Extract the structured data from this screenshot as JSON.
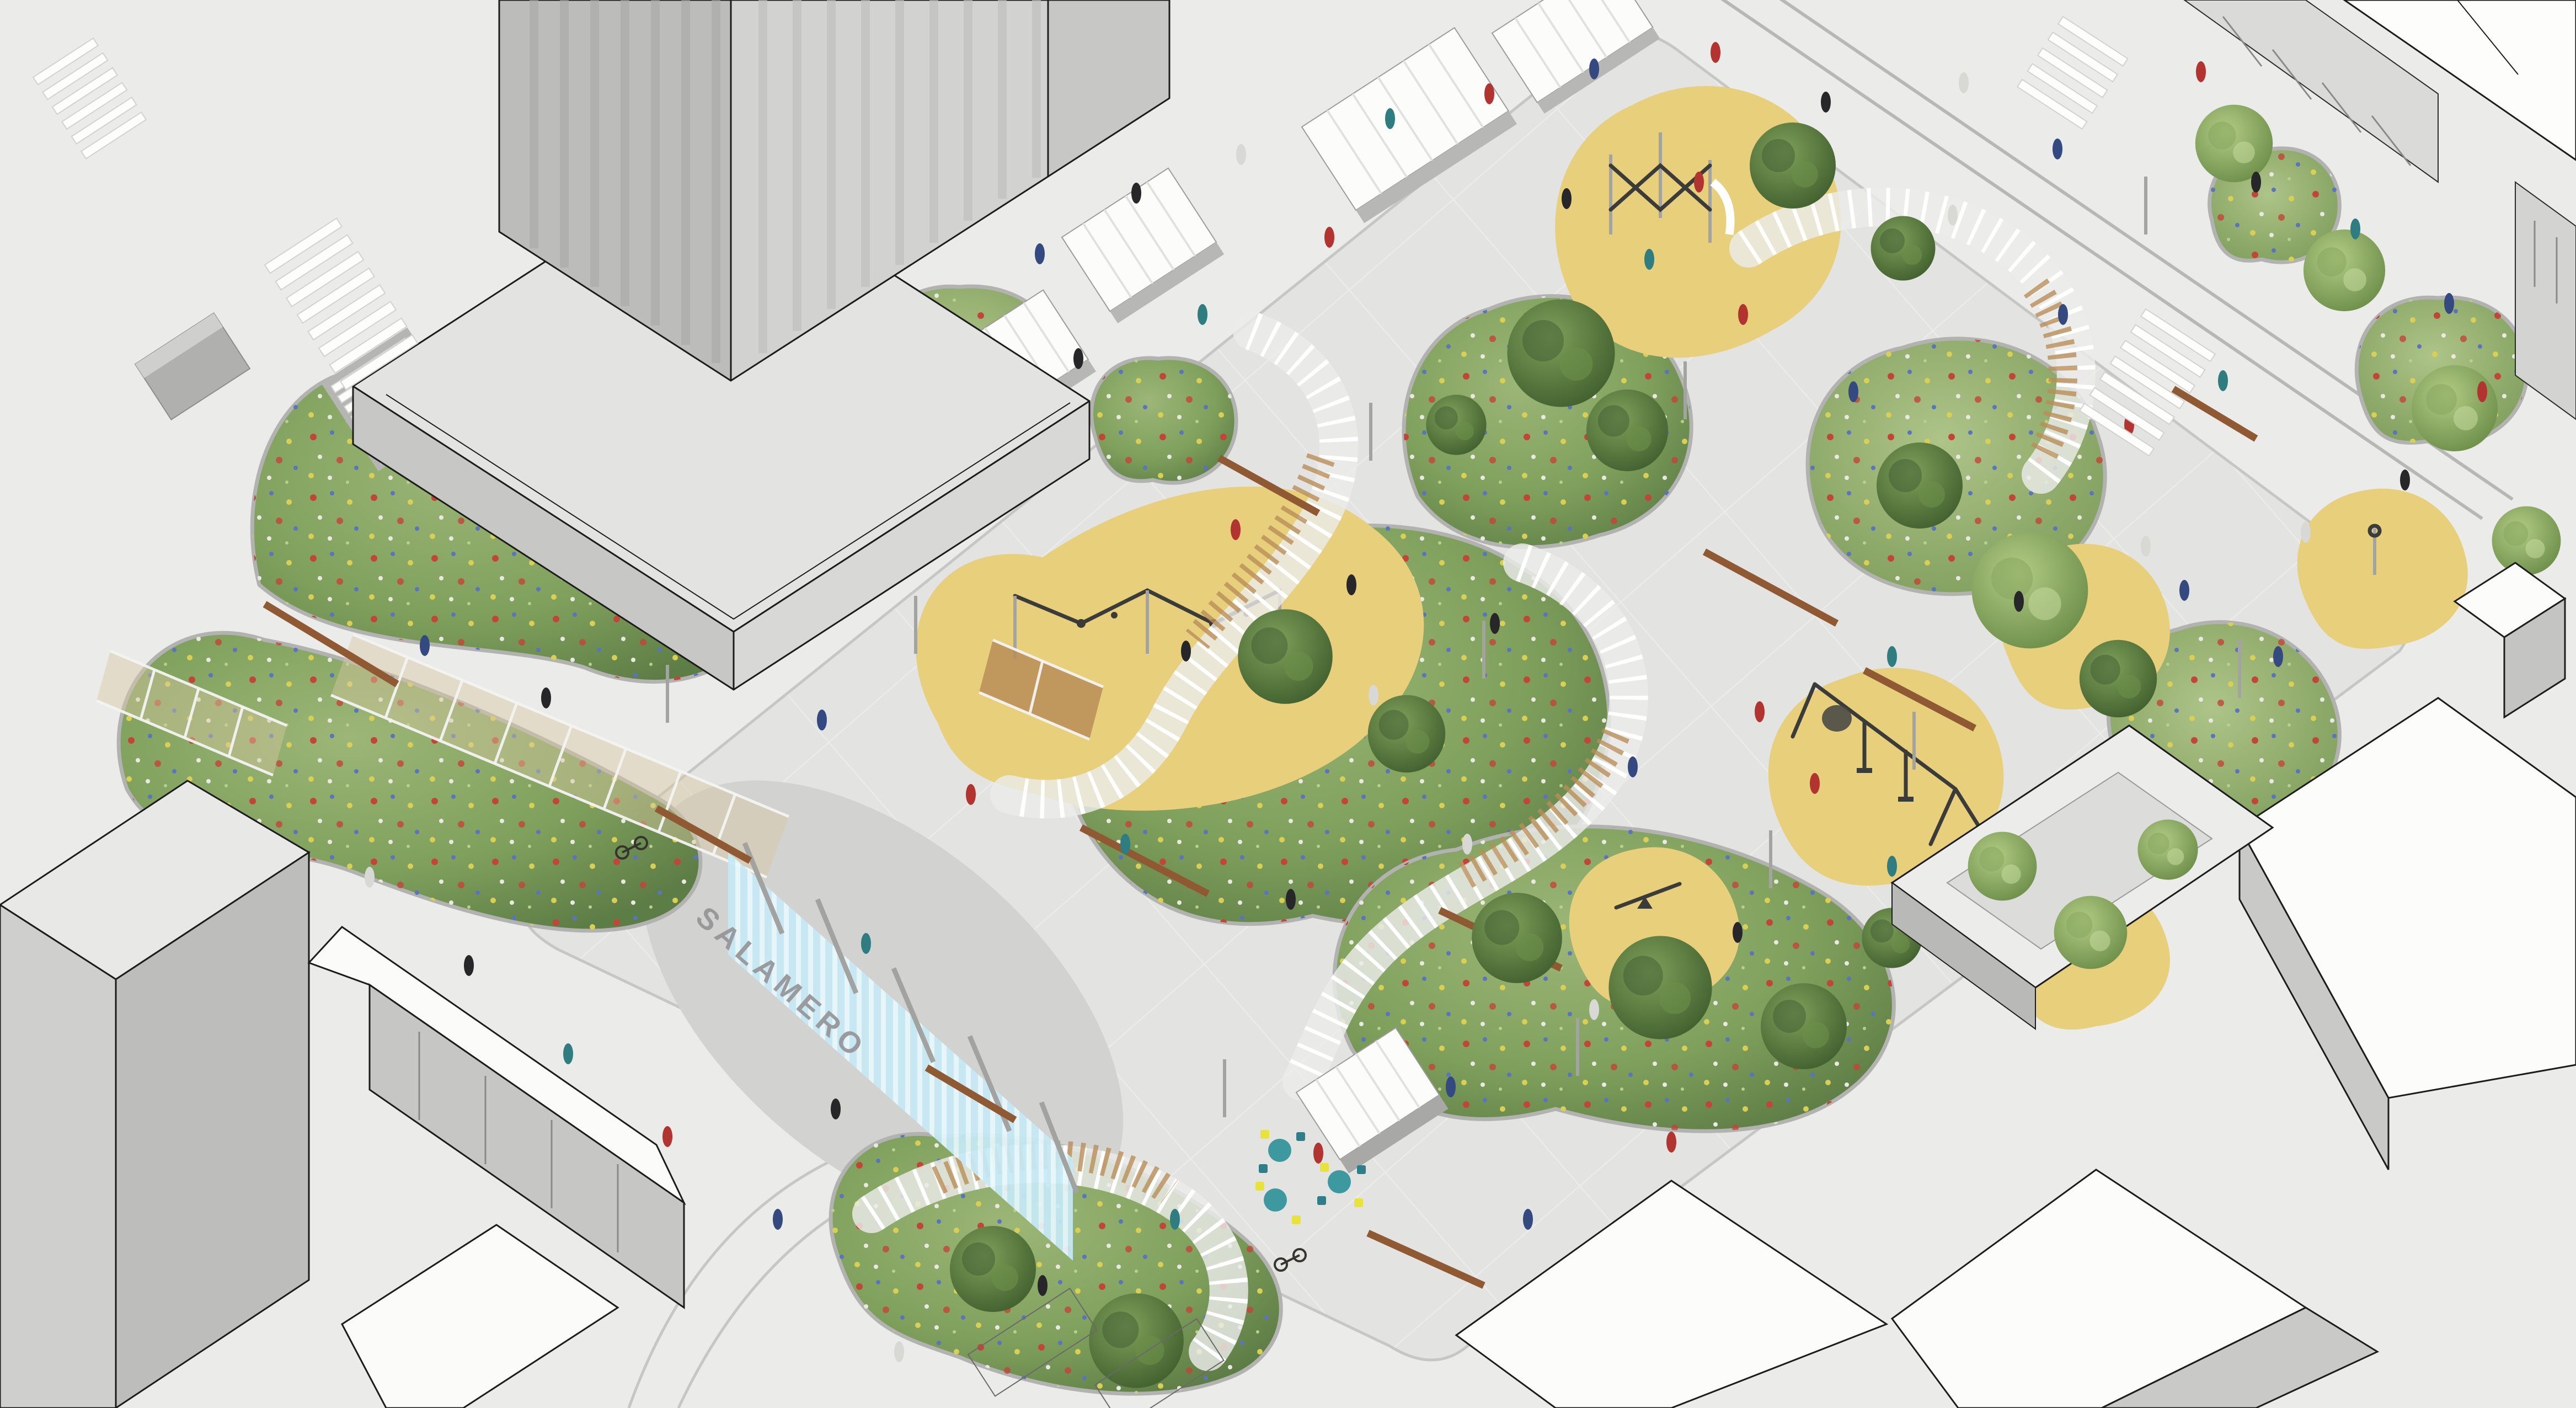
{
  "scene": {
    "title": "Axonometric rendering of an urban plaza park",
    "sign": {
      "label": "SALAMERO"
    }
  },
  "palette": {
    "paving": "#ebebe9",
    "plaza_paving": "#e3e3e1",
    "forecourt": "#d2d2d0",
    "play_surface": "#e7cf7c",
    "roof_white": "#fcfcfb",
    "building_gray": "#c9c9c7",
    "building_dark": "#b0b0ae",
    "outline": "#1c1c1c",
    "corten": "#8f5a33",
    "pergola_mesh": "#b98d57",
    "water_sign_blue": "#c6eaf6",
    "vegetation_green": "#6f8f52",
    "flower_red": "#c2453a",
    "flower_blue": "#5a74bd",
    "flower_yellow": "#d9cf54",
    "table_teal": "#3d98a0",
    "chair_yellow": "#e8e23c"
  }
}
